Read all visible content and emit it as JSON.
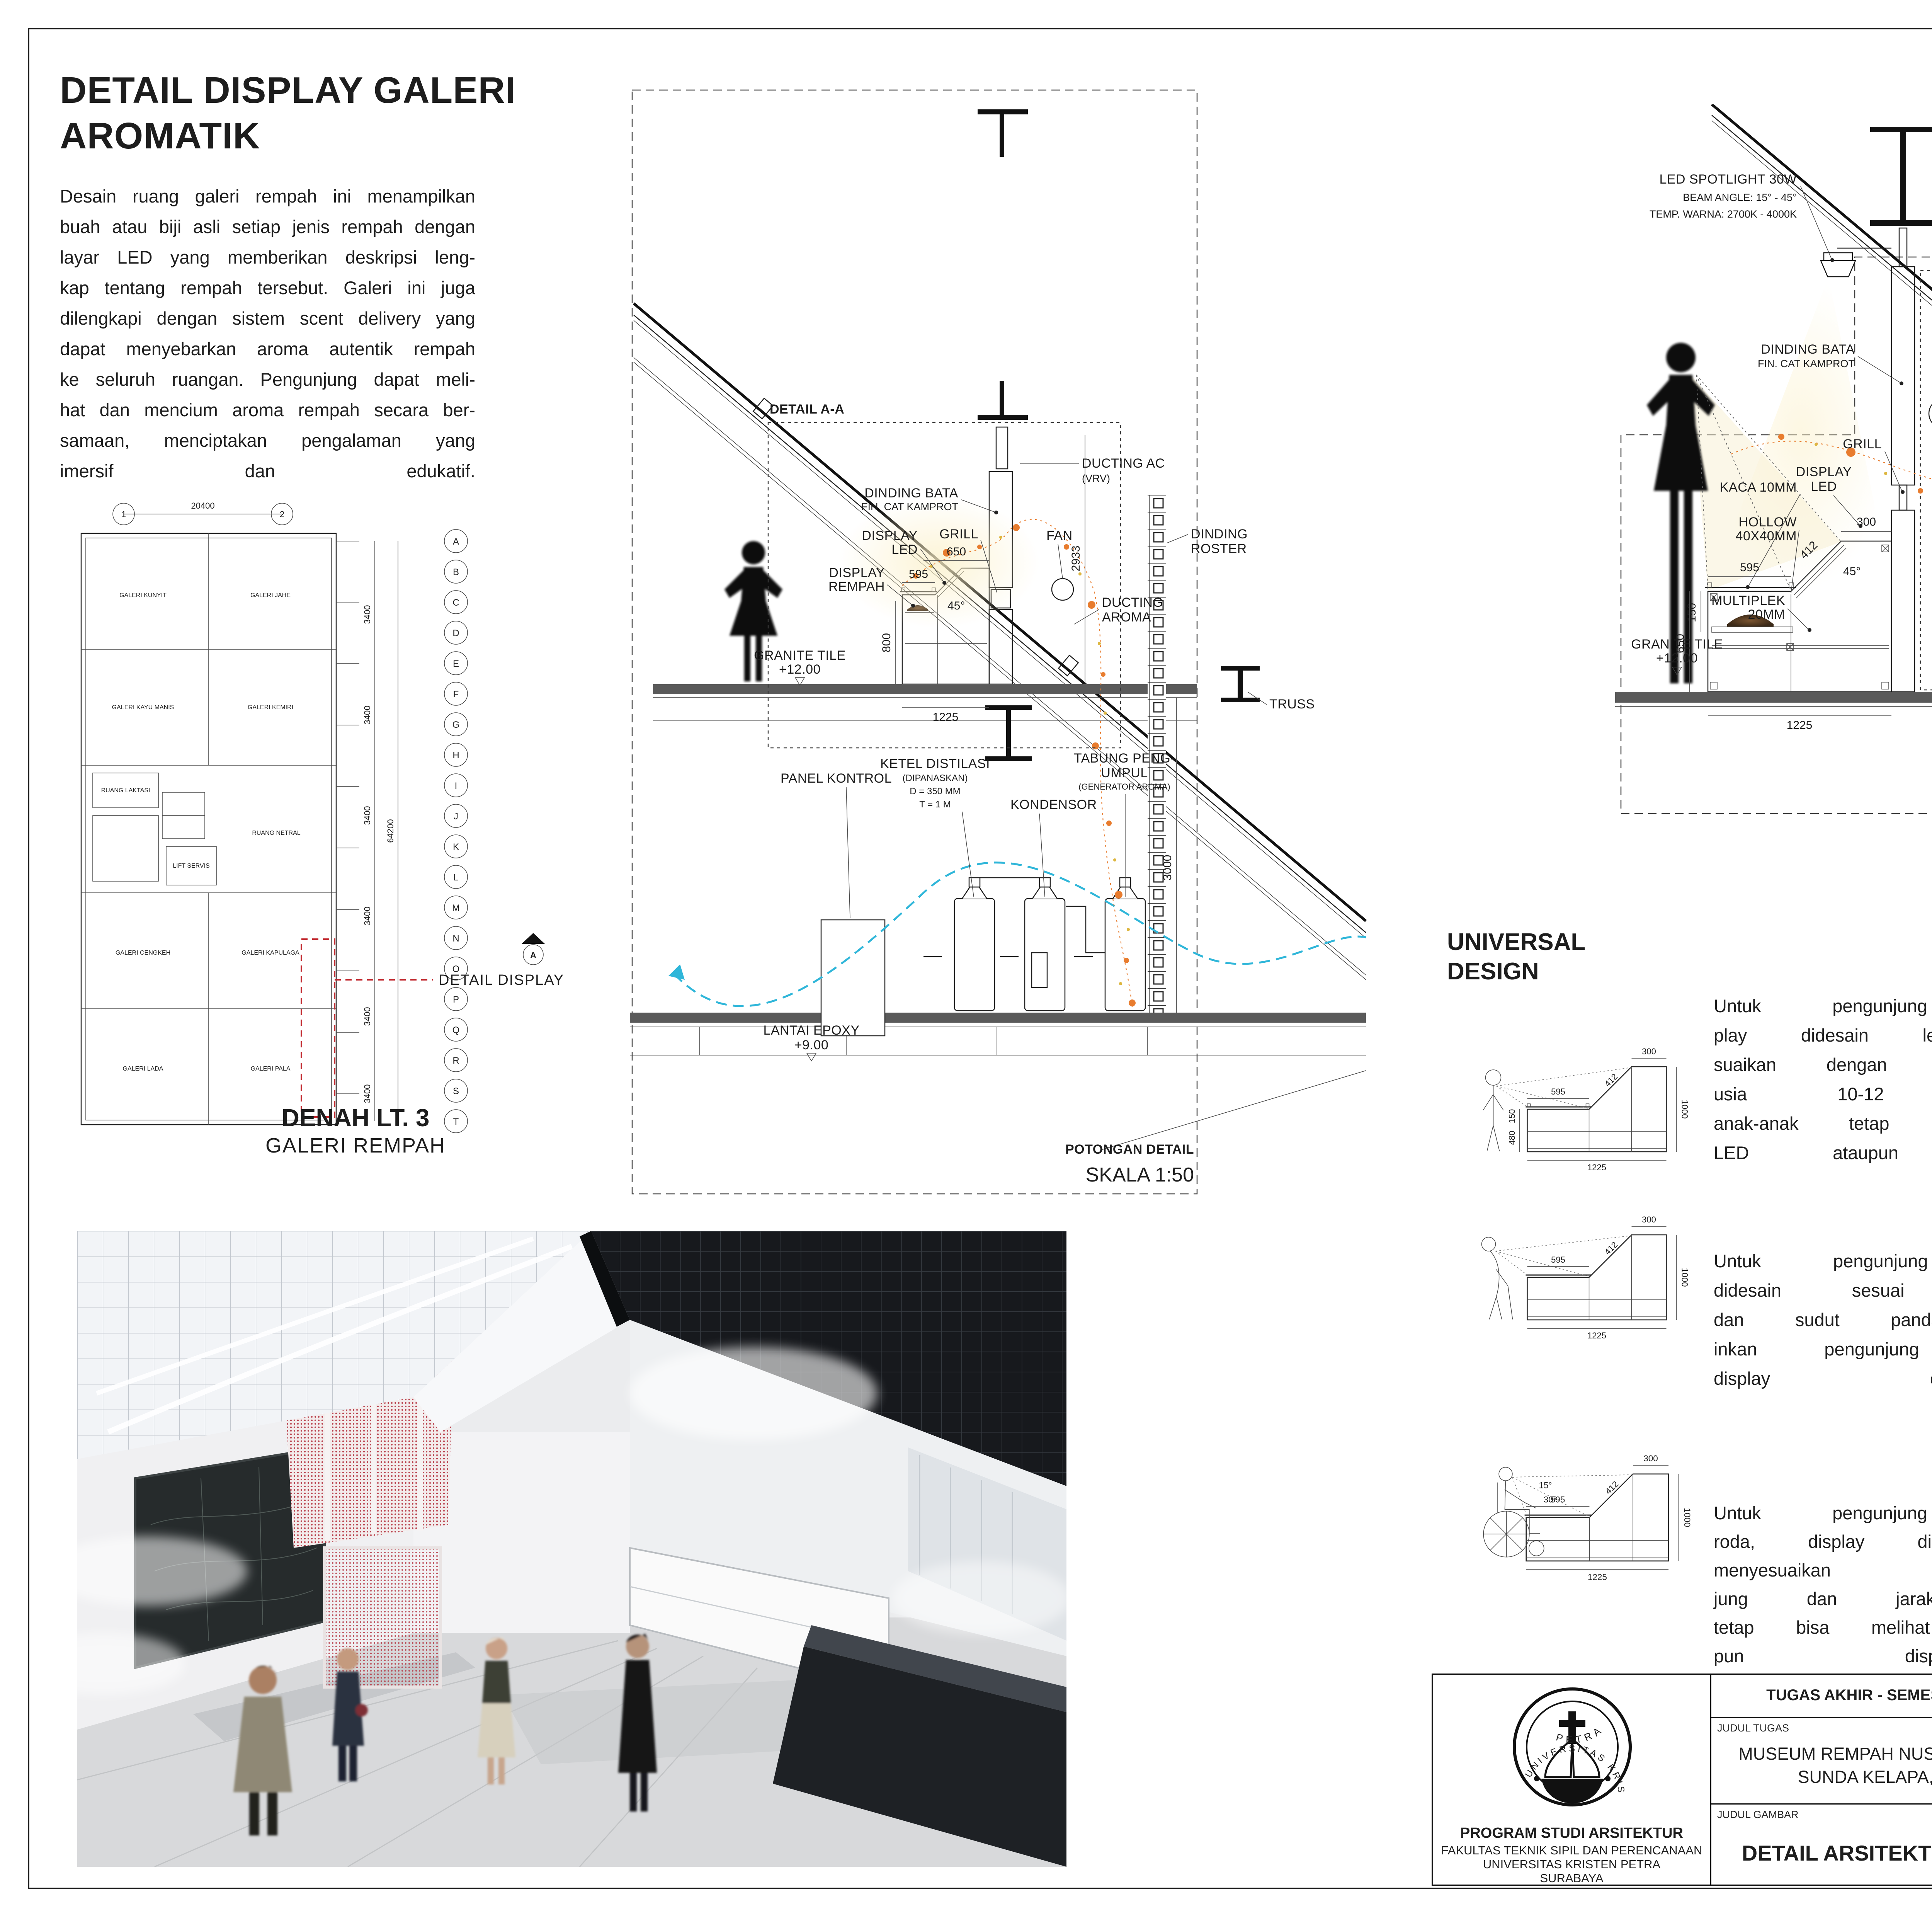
{
  "sheet": {
    "title1": "DETAIL DISPLAY GALERI",
    "title2": "AROMATIK",
    "intro_lines": [
      "Desain ruang galeri rempah ini menampilkan",
      "buah atau biji asli setiap jenis rempah dengan",
      "layar LED yang memberikan deskripsi leng-",
      "kap tentang rempah tersebut. Galeri ini juga",
      "dilengkapi dengan sistem scent delivery yang",
      "dapat menyebarkan aroma autentik rempah",
      "ke seluruh ruangan. Pengunjung dapat meli-",
      "hat dan mencium aroma rempah secara ber-",
      "samaan, menciptakan pengalaman yang",
      "imersif dan edukatif."
    ]
  },
  "plan": {
    "top_dim": "20400",
    "grid_numbers": [
      "1",
      "2"
    ],
    "grid_letters": [
      "A",
      "B",
      "C",
      "D",
      "E",
      "F",
      "G",
      "H",
      "I",
      "J",
      "K",
      "L",
      "M",
      "N",
      "O",
      "P",
      "Q",
      "R",
      "S",
      "T"
    ],
    "spacing": "3400",
    "overall": "64200",
    "rooms": [
      "GALERI KUNYIT",
      "GALERI JAHE",
      "GALERI KAYU MANIS",
      "GALERI KEMIRI",
      "RUANG LAKTASI",
      "LIFT SERVIS",
      "RUANG NETRAL",
      "GALERI CENGKEH",
      "GALERI KAPULAGA",
      "GALERI LADA",
      "GALERI PALA"
    ],
    "callout": "DETAIL DISPLAY",
    "marker": "A",
    "title": "DENAH LT. 3",
    "subtitle": "GALERI REMPAH"
  },
  "potongan": {
    "callout": "DETAIL A-A",
    "labels": {
      "ducting_ac1": "DUCTING AC",
      "ducting_ac2": "(VRV)",
      "bata1": "DINDING BATA",
      "bata2": "FIN. CAT KAMPROT",
      "display1": "DISPLAY",
      "display2": "LED",
      "grill": "GRILL",
      "fan": "FAN",
      "roster1": "DINDING",
      "roster2": "ROSTER",
      "rempah1": "DISPLAY",
      "rempah2": "REMPAH",
      "aroma1": "DUCTING",
      "aroma2": "AROMA",
      "granite1": "GRANITE TILE",
      "granite2": "+12.00",
      "truss": "TRUSS",
      "panel": "PANEL KONTROL",
      "ketel1": "KETEL DISTILASI",
      "ketel2": "(DIPANASKAN)",
      "ketel3": "D = 350 MM",
      "ketel4": "T = 1 M",
      "kondensor": "KONDENSOR",
      "tabung1": "TABUNG PENG-",
      "tabung2": "UMPUL",
      "tabung3": "(GENERATOR AROMA)",
      "lantai1": "LANTAI EPOXY",
      "lantai2": "+9.00"
    },
    "dims": {
      "d595": "595",
      "d650": "650",
      "d45": "45°",
      "d800": "800",
      "d1225": "1225",
      "d2933": "2933",
      "d3000": "3000"
    },
    "title": "POTONGAN DETAIL",
    "scale": "SKALA 1:50"
  },
  "aa": {
    "labels": {
      "spot1": "LED SPOTLIGHT 30W",
      "spot2": "BEAM ANGLE: 15° - 45°",
      "spot3": "TEMP. WARNA: 2700K - 4000K",
      "vrv1": "DUCTING AC",
      "vrv2": "(VRV)",
      "bata1": "DINDING BATA",
      "bata2": "FIN. CAT KAMPROT",
      "grill": "GRILL",
      "fan": "FAN",
      "kaca": "KACA 10MM",
      "display1": "DISPLAY",
      "display2": "LED",
      "hollow1": "HOLLOW",
      "hollow2": "40X40MM",
      "multi1": "MULTIPLEK",
      "multi2": "20MM",
      "granite1": "GRANITE TILE",
      "granite2": "+12.00"
    },
    "dims": {
      "d2933": "2933",
      "d300": "300",
      "d150a": "150",
      "d370": "370",
      "d720": "720",
      "d650": "650",
      "d595": "595",
      "d412": "412",
      "d45": "45°",
      "d150b": "150",
      "d1225": "1225"
    },
    "title": "DETAIL A-A",
    "scale": "SKALA 1:25"
  },
  "universal": {
    "h1": "UNIVERSAL",
    "h2": "DESIGN",
    "p1": [
      "Untuk pengunjung anak-anak, dis-",
      "play didesain lebih pendek menye-",
      "suaikan dengan tinggi rata-rata anak",
      "usia 10-12 tahun, sehingga",
      "anak-anak tetap bisa melihat display",
      "LED ataupun display rempah."
    ],
    "p2": [
      "Untuk pengunjung normal, display",
      "didesain sesuai standar ketinggian",
      "dan sudut pandang yang memungk-",
      "inkan pengunjung dapat mengamati",
      "display dengan baik."
    ],
    "p3": [
      "Untuk pengunjung pengguna kursi",
      "roda, display didesain lebih pendek",
      "menyesuaikan kebutuhan pengun-",
      "jung dan jarak pandangnya agar",
      "tetap bisa melihat display LED atau-",
      "pun display rempah."
    ],
    "figdims": {
      "d300": "300",
      "d412": "412",
      "d595": "595",
      "d150": "150",
      "d480": "480",
      "d1000": "1000",
      "d1225": "1225",
      "a15": "15°",
      "a30": "30°"
    }
  },
  "products": {
    "led_caption": "LED SCREEN",
    "adj_heading": "Adjustable angle",
    "adj_sub1": "Touth is not a time of life state of mind no maters",
    "adj_sub2": "cheers red lips AND supple kness well",
    "a350": "350°",
    "a180": "180°",
    "focusing": "Focusing",
    "plus": "+",
    "range": "15°-60°",
    "spot_caption": "SPOTLIGHT LAMP",
    "views": "VIEWS",
    "duct24": "24\"",
    "duct8": "8\"",
    "duct_label": "DUCT HOLE",
    "front256": "25.6\"",
    "front96": "9.6\"",
    "front_label": "FRONT VIEW",
    "back233": "23.3\"",
    "back73": "7.3\"",
    "back_label": "BACK VIEW",
    "lateral": "LATERAL VIEW",
    "tip": "This measurement should fit the duct hole.",
    "model": "L-RA 24\" x 8\"",
    "spec": "[24\" x 8\" Duct Hole][25.6\" x 9.6\" Face]",
    "grill_caption": "ALUMINIUM GRILL"
  },
  "bb": {
    "h1": "MAINTENANCE",
    "h2": "DISPLAY",
    "labels": {
      "kaca": "KACA 10MM",
      "pin": "PIN KACA",
      "tabokan1": "TABOKAN",
      "tabokan2": "2MM",
      "laci1": "LACI MULTIPLEK",
      "laci2": "2MM",
      "hollow1": "HOLLOW",
      "hollow2": "40X40MM"
    },
    "title": "DETAIL B-B",
    "scale": "SKALA 1:10",
    "p": [
      "Display yang berupa buah asli me-",
      "merlukan maintenance secara berka-",
      "la, sehingga desain display menggu-",
      "nakan laci yang dapat dibuka saat",
      "waktu maintenance oleh staff."
    ]
  },
  "tb": {
    "header": "TUGAS AKHIR - SEMESTER GENAP 2023/2024",
    "judul_tugas_label": "JUDUL TUGAS",
    "judul_tugas1": "MUSEUM REMPAH NUSANTARA DI PELABUHAN",
    "judul_tugas2": "SUNDA KELAPA, JAKARTA UTARA",
    "judul_gambar_label": "JUDUL GAMBAR",
    "judul_gambar": "DETAIL ARSITEKTUR",
    "skala_label": "SKALA",
    "skala1": "1:50",
    "skala2": "1:25",
    "skala3": "1:10",
    "nama_label": "NAMA",
    "nama": "LOUISA ELIZABETH S.",
    "nrp_label": "NRP",
    "nrp": "B12200055",
    "kelompok_label": "KELOMPOK",
    "kelompok": "08",
    "mentor_utama_label": "MENTOR UTAMA",
    "mentor_utama": "CHRISTINE WONOSEPUTRO, S.T., M.ASD.",
    "mentor_pendamping_label": "MENTOR PENDAMPING",
    "mentor_p1": "IR. BENNY POERBANTANOE, MSP.",
    "mentor_p2": "IR. WANDA WIDIGDO CANADARMA, M.SI.",
    "pengesahan_label": "PENGESAHAN",
    "lembar_label": "LEMBAR",
    "jumlah_label": "JUMLAH",
    "tanggal_label": "TANGGAL",
    "program1": "PROGRAM STUDI ARSITEKTUR",
    "program2": "FAKULTAS TEKNIK SIPIL DAN PERENCANAAN",
    "program3": "UNIVERSITAS KRISTEN PETRA",
    "program4": "SURABAYA",
    "logo_top": "UNIVERSITAS KRISTEN",
    "logo_bottom": "PETRA"
  }
}
